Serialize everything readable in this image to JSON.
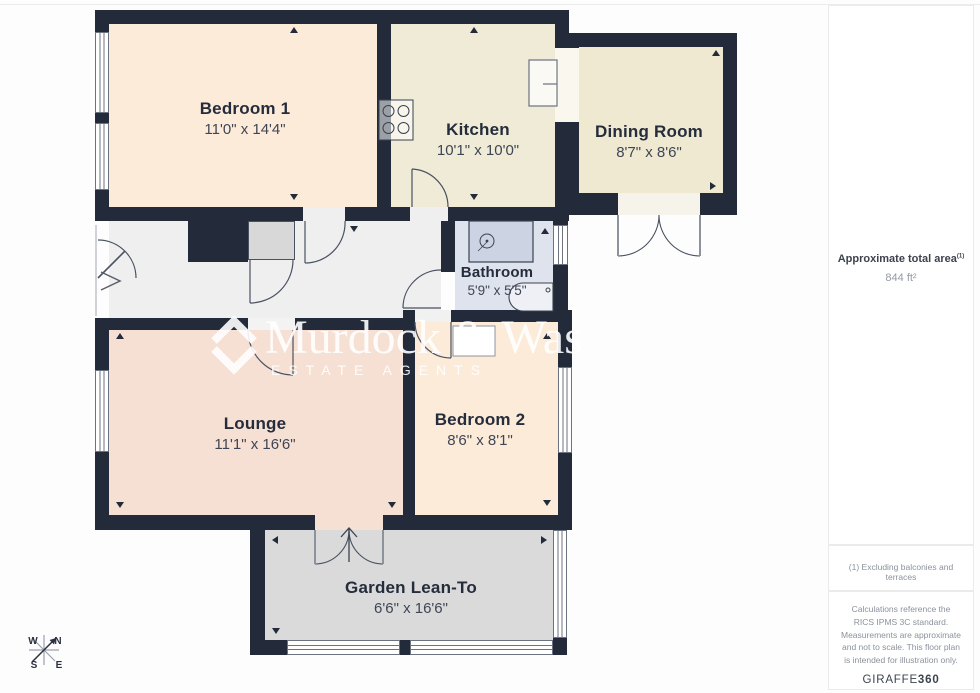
{
  "plan": {
    "rooms": [
      {
        "name": "Bedroom 1",
        "dims": "11'0\" x 14'4\""
      },
      {
        "name": "Kitchen",
        "dims": "10'1\" x 10'0\""
      },
      {
        "name": "Dining Room",
        "dims": "8'7\" x 8'6\""
      },
      {
        "name": "Bathroom",
        "dims": "5'9\" x 5'5\""
      },
      {
        "name": "Lounge",
        "dims": "11'1\" x 16'6\""
      },
      {
        "name": "Bedroom 2",
        "dims": "8'6\" x 8'1\""
      },
      {
        "name": "Garden Lean-To",
        "dims": "6'6\" x 16'6\""
      }
    ],
    "colors": {
      "wall": "#232b3b",
      "bedroom1": "#fcebd9",
      "kitchen": "#f0ebd6",
      "dining": "#f0e9d2",
      "bathroom": "#dfe3ee",
      "hall": "#efeff0",
      "lounge": "#f6dfd3",
      "bedroom2": "#fcebd9",
      "garden": "#dadada"
    }
  },
  "watermark": {
    "name": "Murdock & Was",
    "tagline": "ESTATE AGENTS"
  },
  "compass": {
    "n": "N",
    "e": "E",
    "s": "S",
    "w": "W"
  },
  "sidebar": {
    "area_label": "Approximate total area",
    "area_sup": "(1)",
    "area_value": "844 ft²",
    "footnote": "(1) Excluding balconies and terraces",
    "disclaimer": "Calculations reference the RICS IPMS 3C standard. Measurements are approximate and not to scale. This floor plan is intended for illustration only.",
    "brand": "GIRAFFE",
    "brand_bold": "360"
  }
}
